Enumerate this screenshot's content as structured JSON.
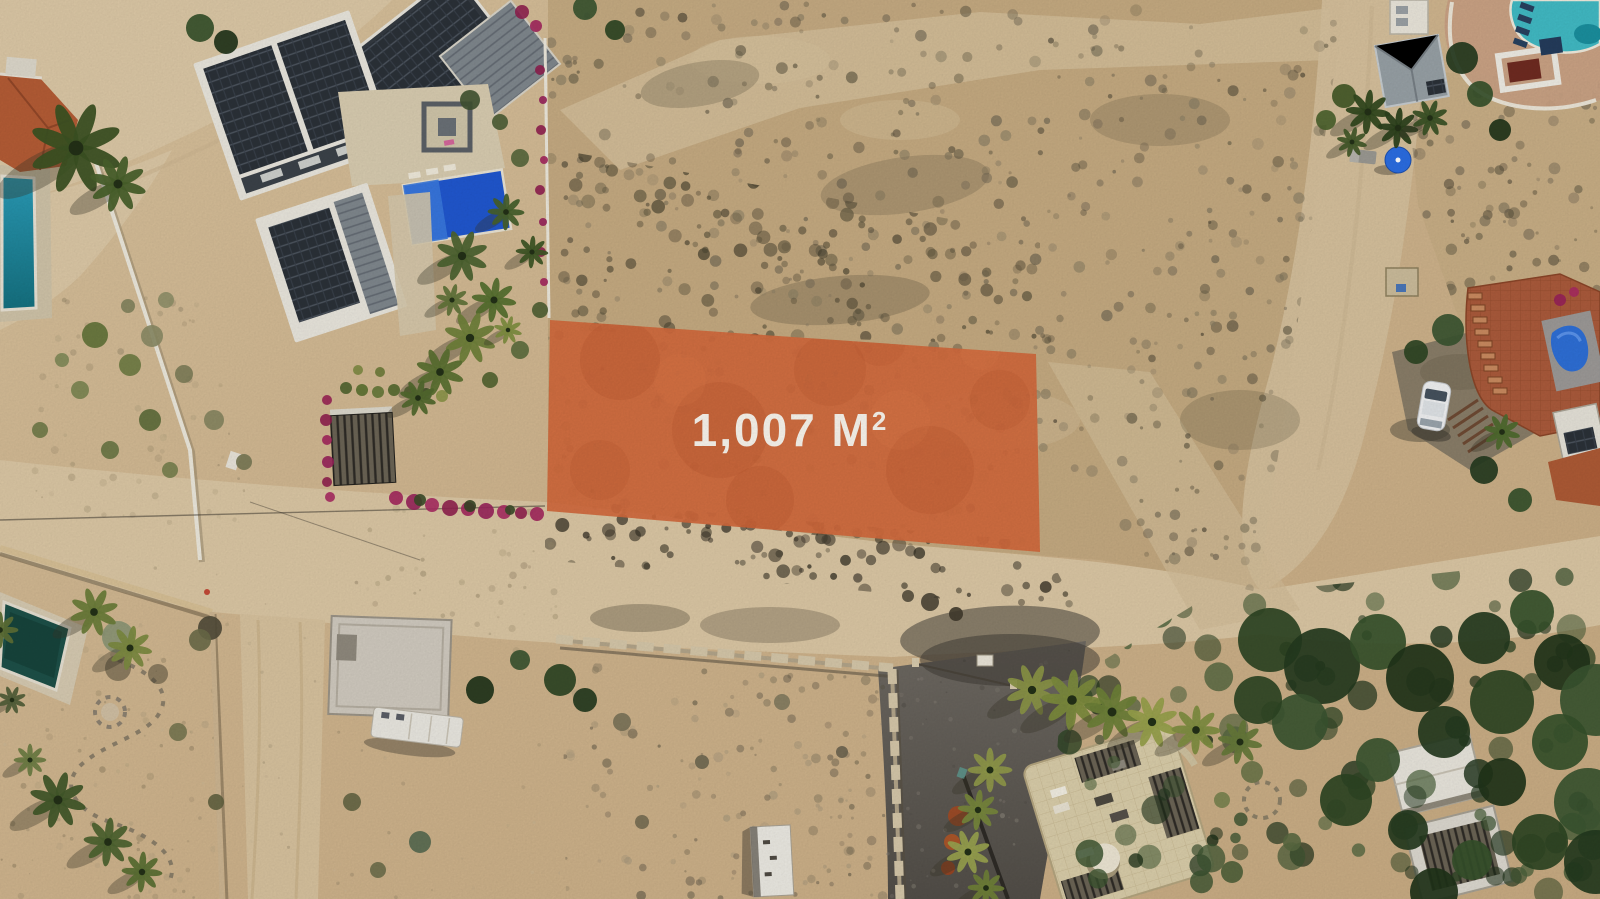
{
  "overlay_label": {
    "area_text": "1,007 M",
    "area_superscript": "2",
    "area_full_text": "1,007 M²"
  },
  "lot_highlight": {
    "fill_color": "#d2693c",
    "text_color": "#f9f5ed"
  },
  "scene_colors": {
    "sand": "#cdb28b",
    "sand_road": "#dbc7a4",
    "scrub_field": "#c3a980",
    "paved_road_dark": "#5e5952",
    "pool_royal_blue": "#2057cf",
    "pool_teal": "#2496b1",
    "pool_turquoise": "#41bac4",
    "pool_dark_green": "#1d5048",
    "solar_panel_dark": "#2b3138",
    "villa_roof_charcoal": "#343a41",
    "terracotta_roof": "#b45c35",
    "terrace_tile_red": "#aa5a3b",
    "white_wall": "#ece8dc",
    "crenellated_wall_tan": "#d5c7a9",
    "vegetation_dark_green": "#2d4423",
    "palm_yellow_green": "#7c8b3d",
    "bougainvillea_magenta": "#a2255c",
    "white_car": "#f0f1f2",
    "blue_umbrella": "#2b6de2",
    "blue_tarp": "#2e6fd6"
  },
  "scene_features": [
    "aerial-drone-photo",
    "highlighted-land-lot",
    "dirt-roads",
    "desert-scrub-field",
    "solar-roof-villa",
    "swimming-pools",
    "crenellated-wall",
    "white-trailer",
    "palm-trees"
  ]
}
